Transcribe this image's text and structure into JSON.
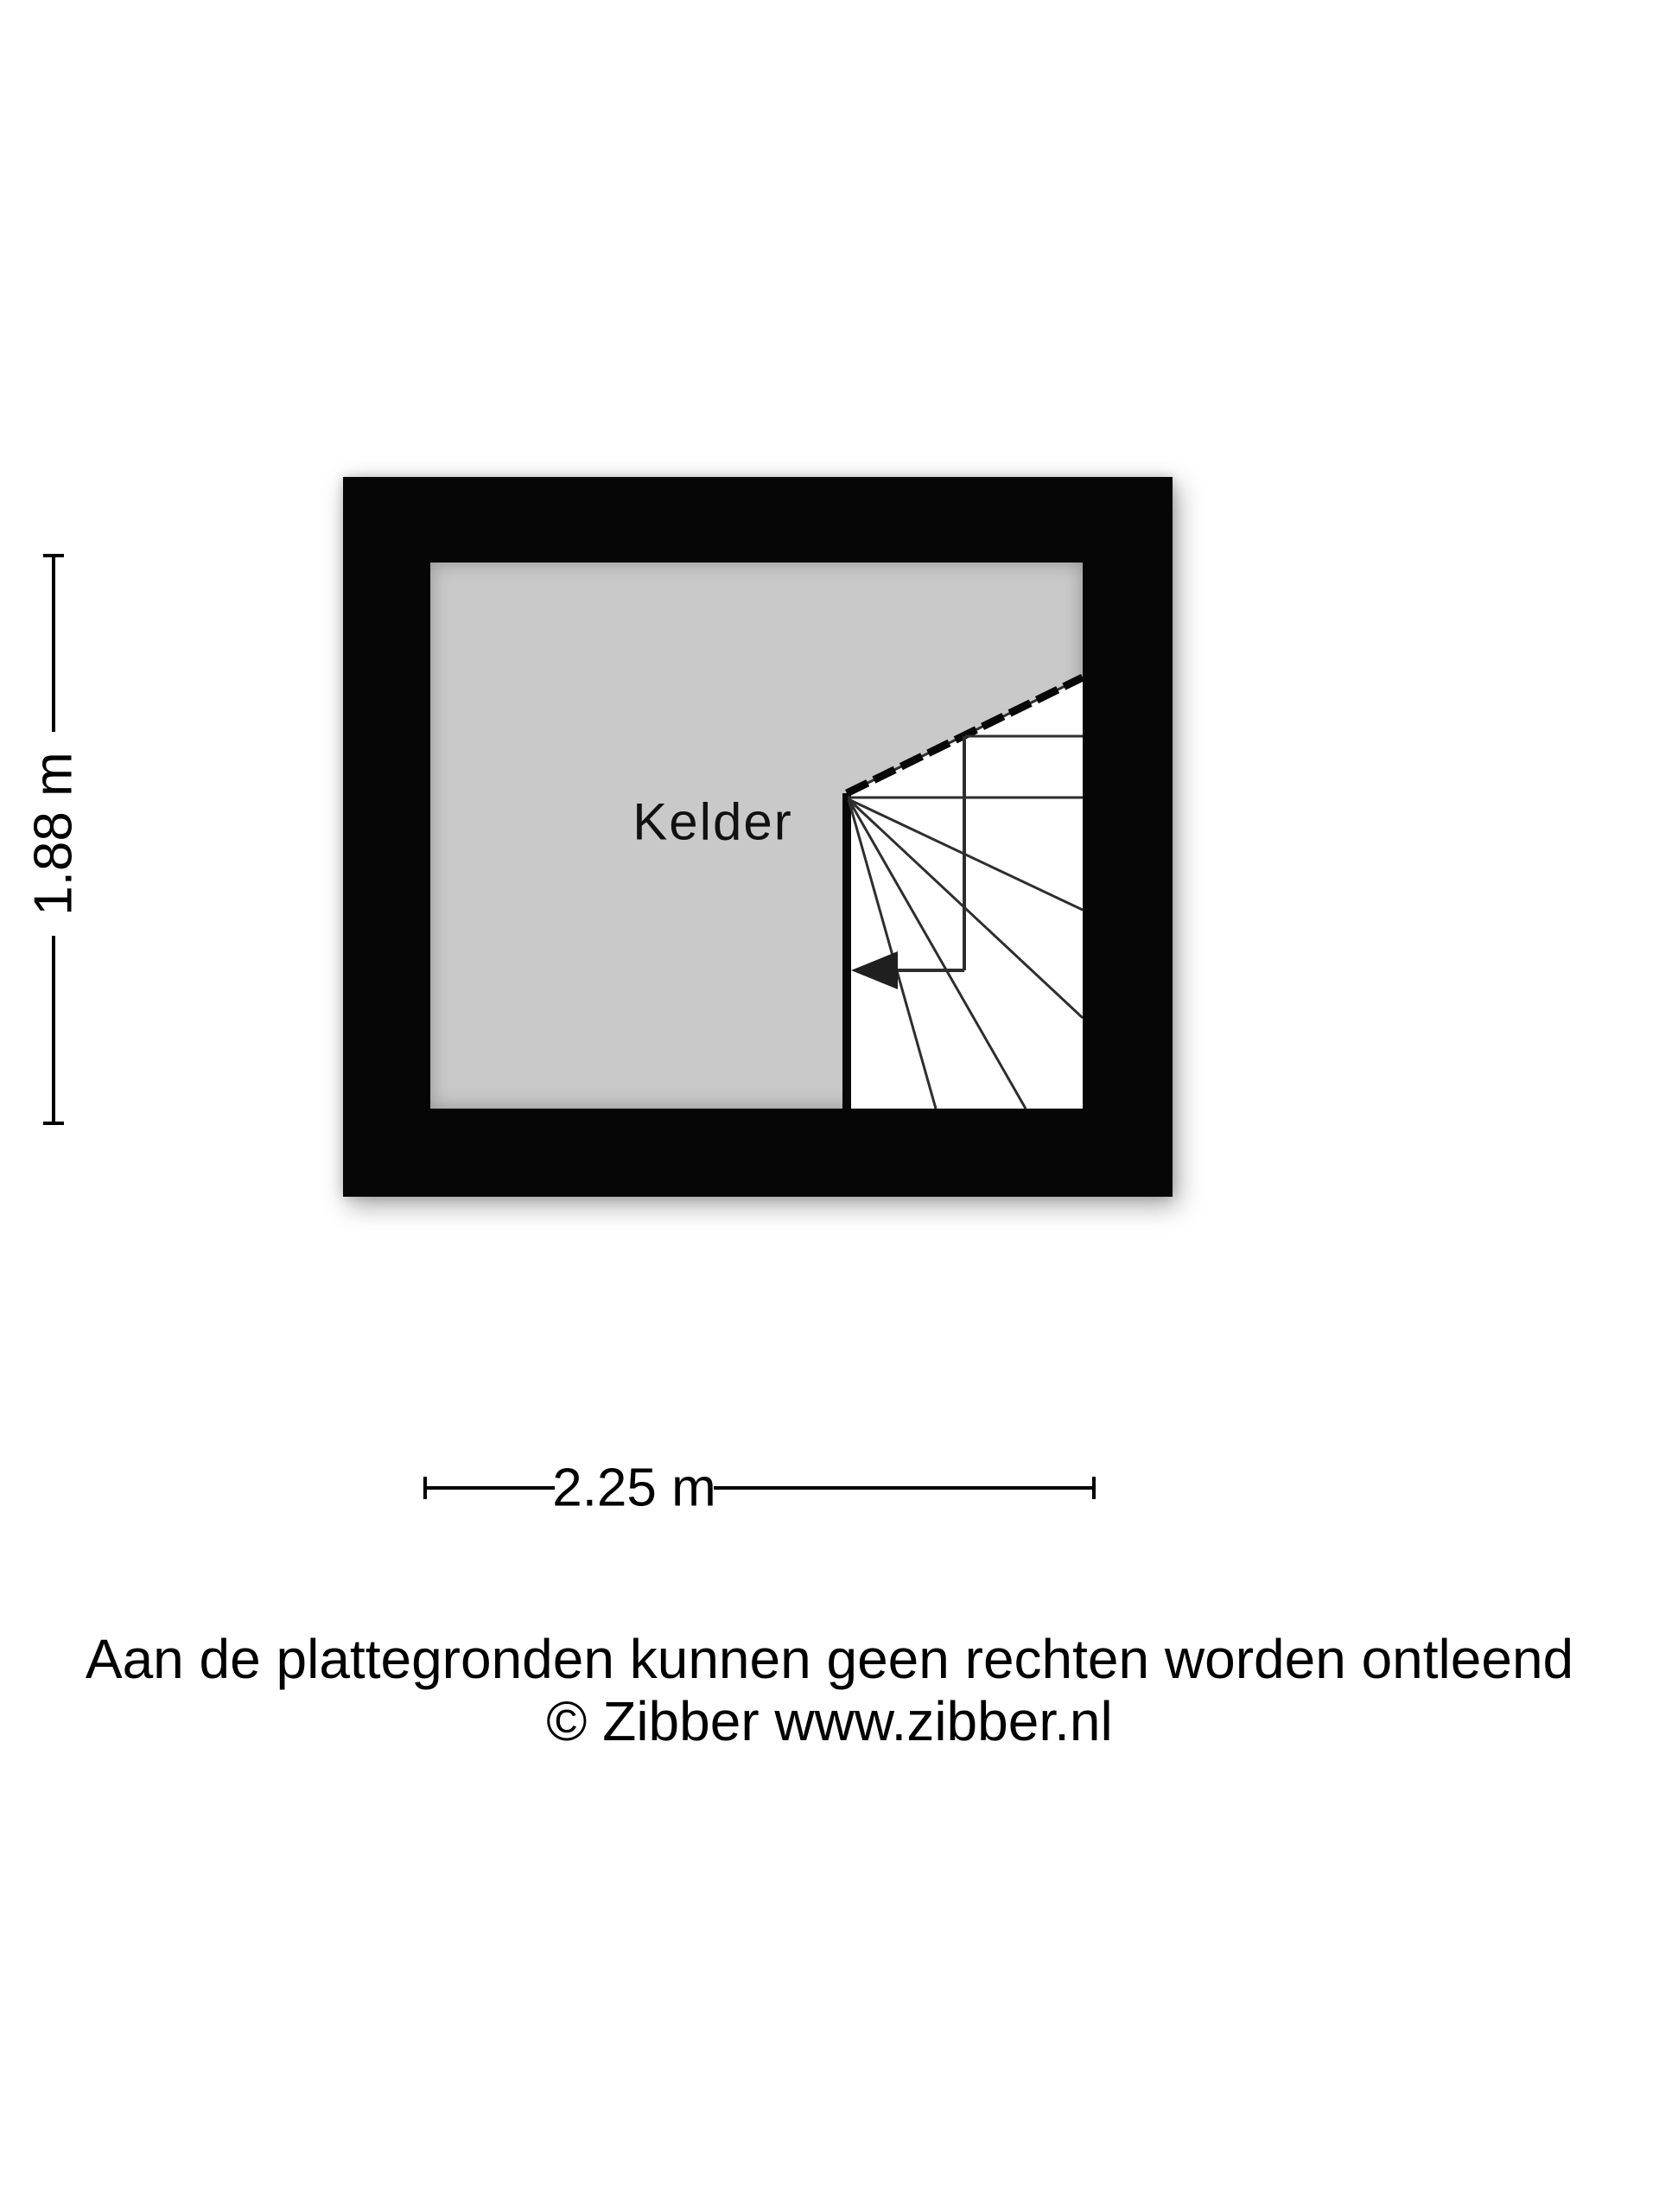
{
  "floorplan": {
    "room_label": "Kelder",
    "height_label": "1.88 m",
    "width_label": "2.25 m",
    "colors": {
      "wall": "#060606",
      "floor": "#c9c9c9",
      "stair_area": "#ffffff",
      "stair_lines": "#2e2e2e",
      "background": "#ffffff"
    }
  },
  "footer": {
    "line1": "Aan de plattegronden kunnen geen rechten worden ontleend",
    "line2": "© Zibber www.zibber.nl"
  }
}
